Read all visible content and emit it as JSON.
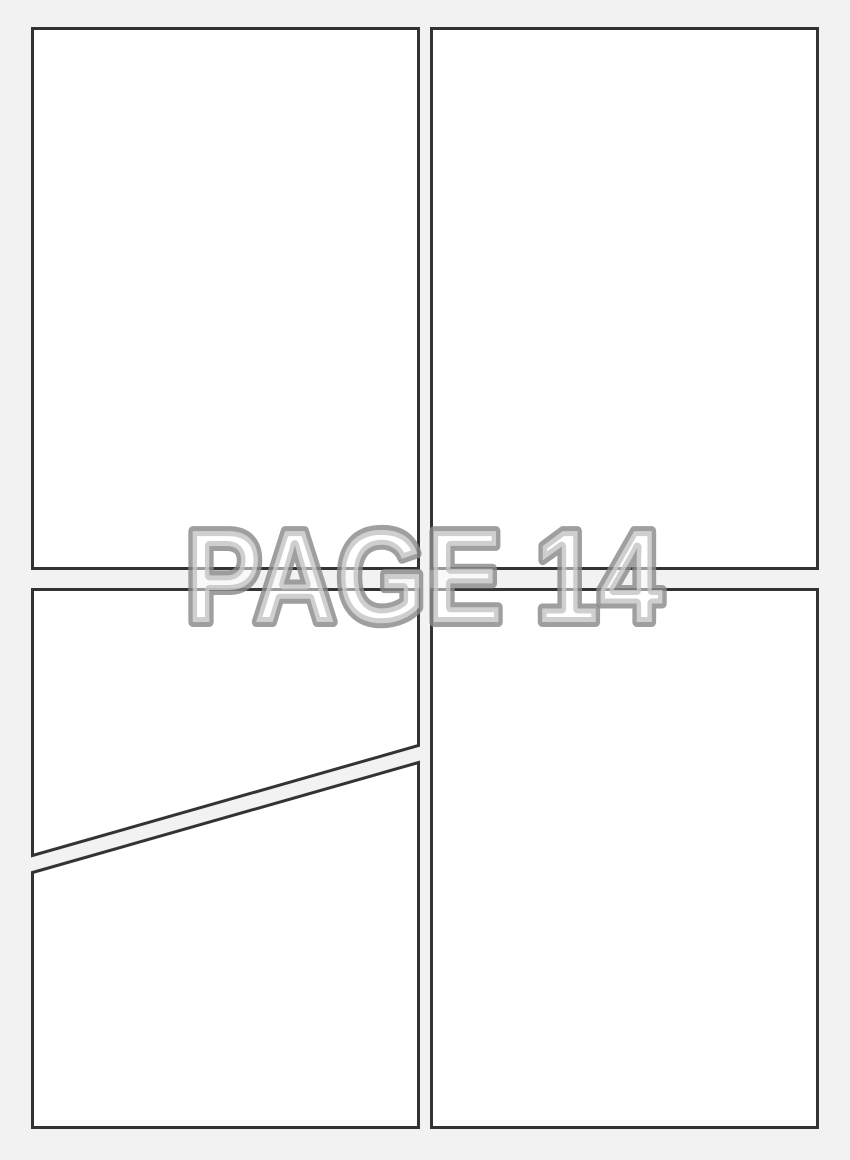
{
  "watermark": {
    "label": "PAGE 14",
    "page_number": 14
  },
  "colors": {
    "page_background": "#f2f2f2",
    "panel_fill": "#ffffff",
    "panel_border": "#333333",
    "watermark_outline": "#9b9b9b",
    "watermark_fill": "#f5f5f5"
  }
}
